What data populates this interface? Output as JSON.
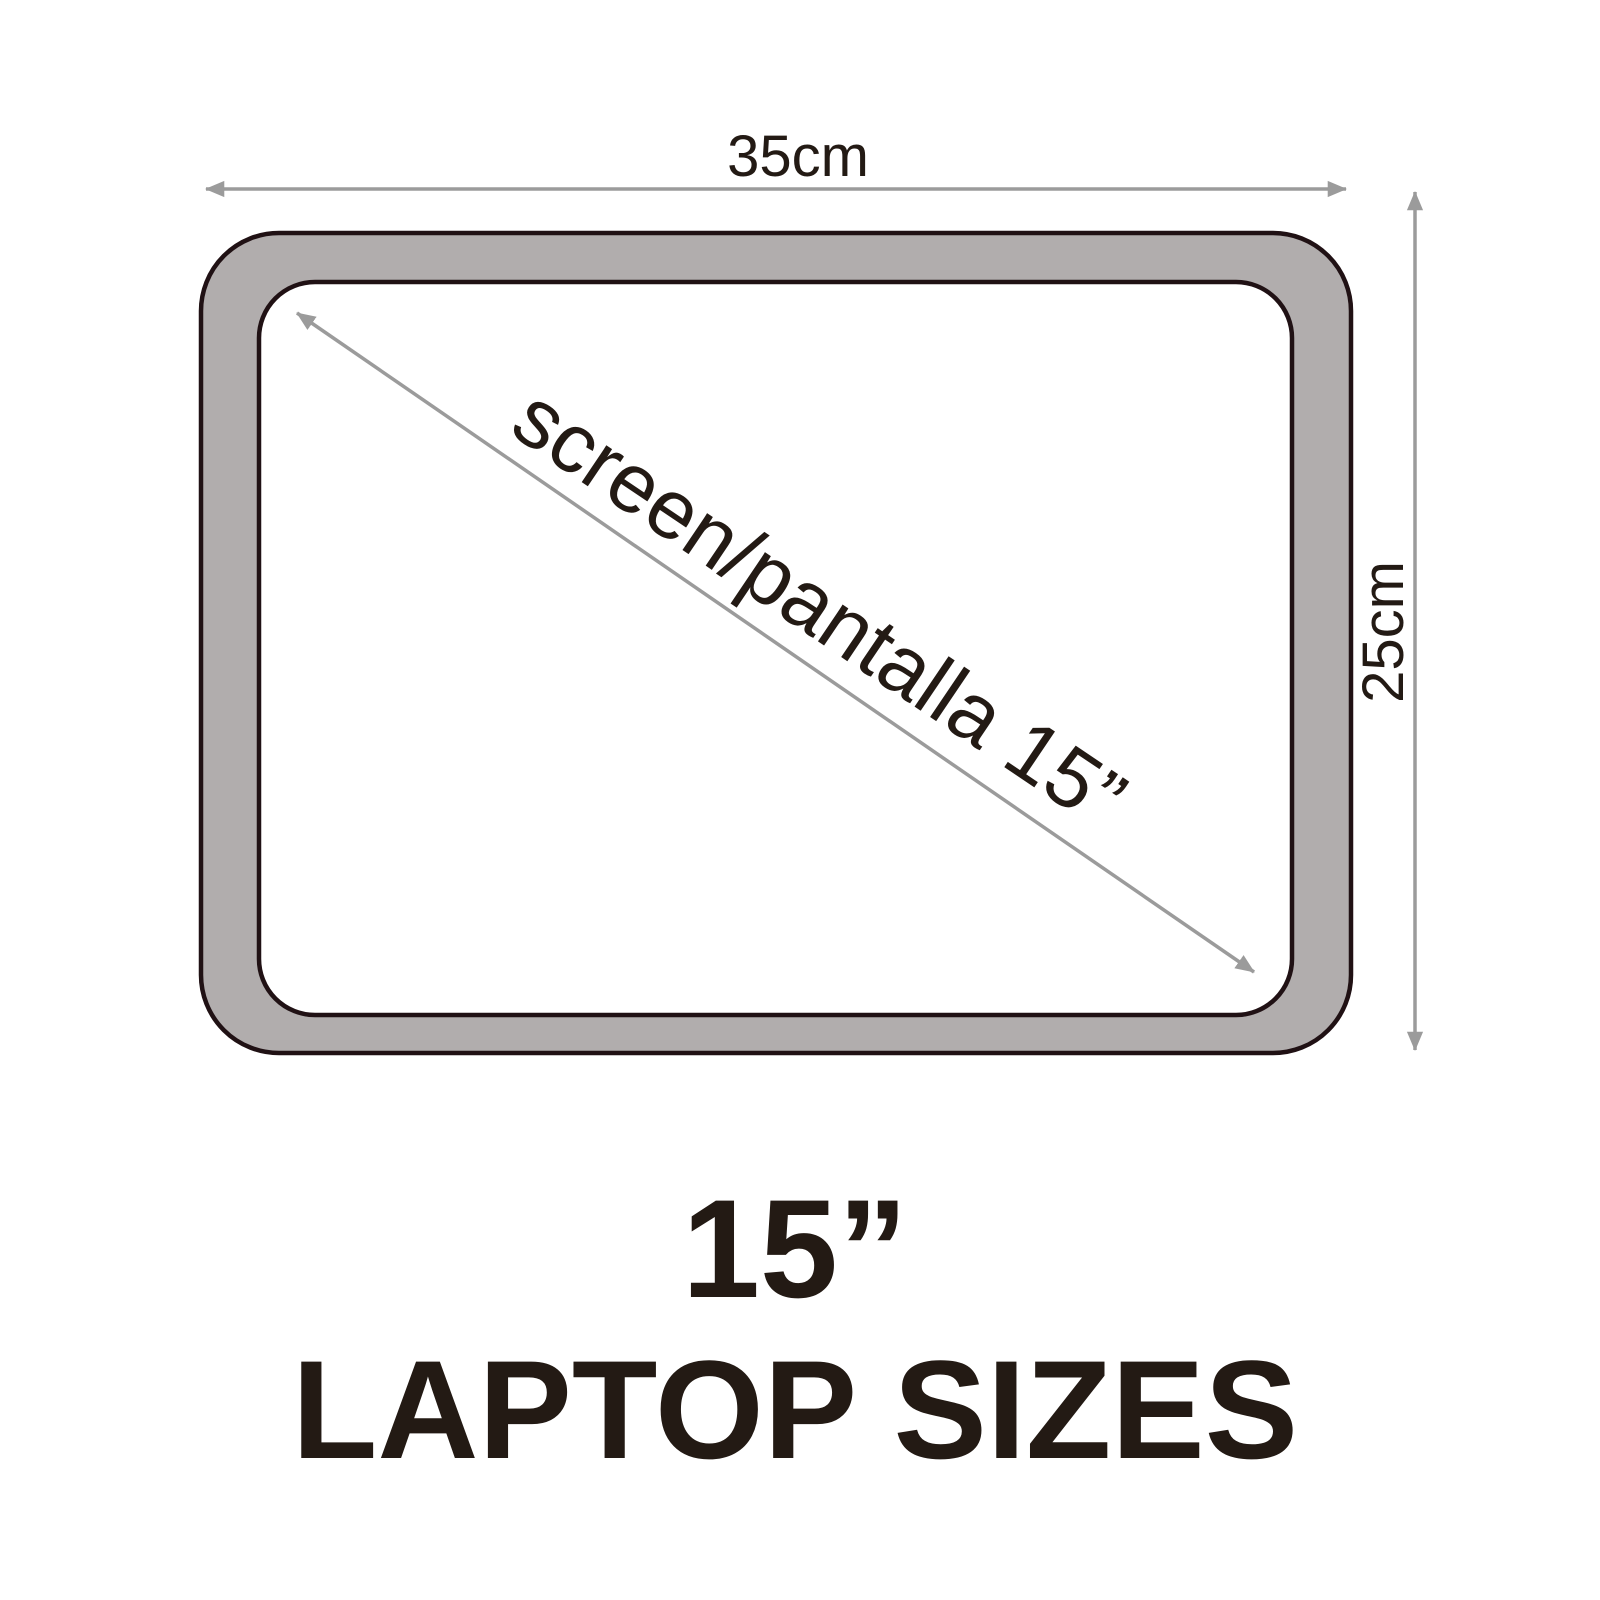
{
  "diagram": {
    "kind": "laptop-dimension-diagram",
    "width_label": "35cm",
    "height_label": "25cm",
    "diagonal_label": "screen/pantalla 15”",
    "title_line1": "15”",
    "title_line2": "LAPTOP SIZES",
    "colors": {
      "background": "#ffffff",
      "bezel": "#b1adad",
      "screen": "#ffffff",
      "outline": "#201114",
      "arrow": "#9b9b9b",
      "text": "#231a14"
    }
  }
}
